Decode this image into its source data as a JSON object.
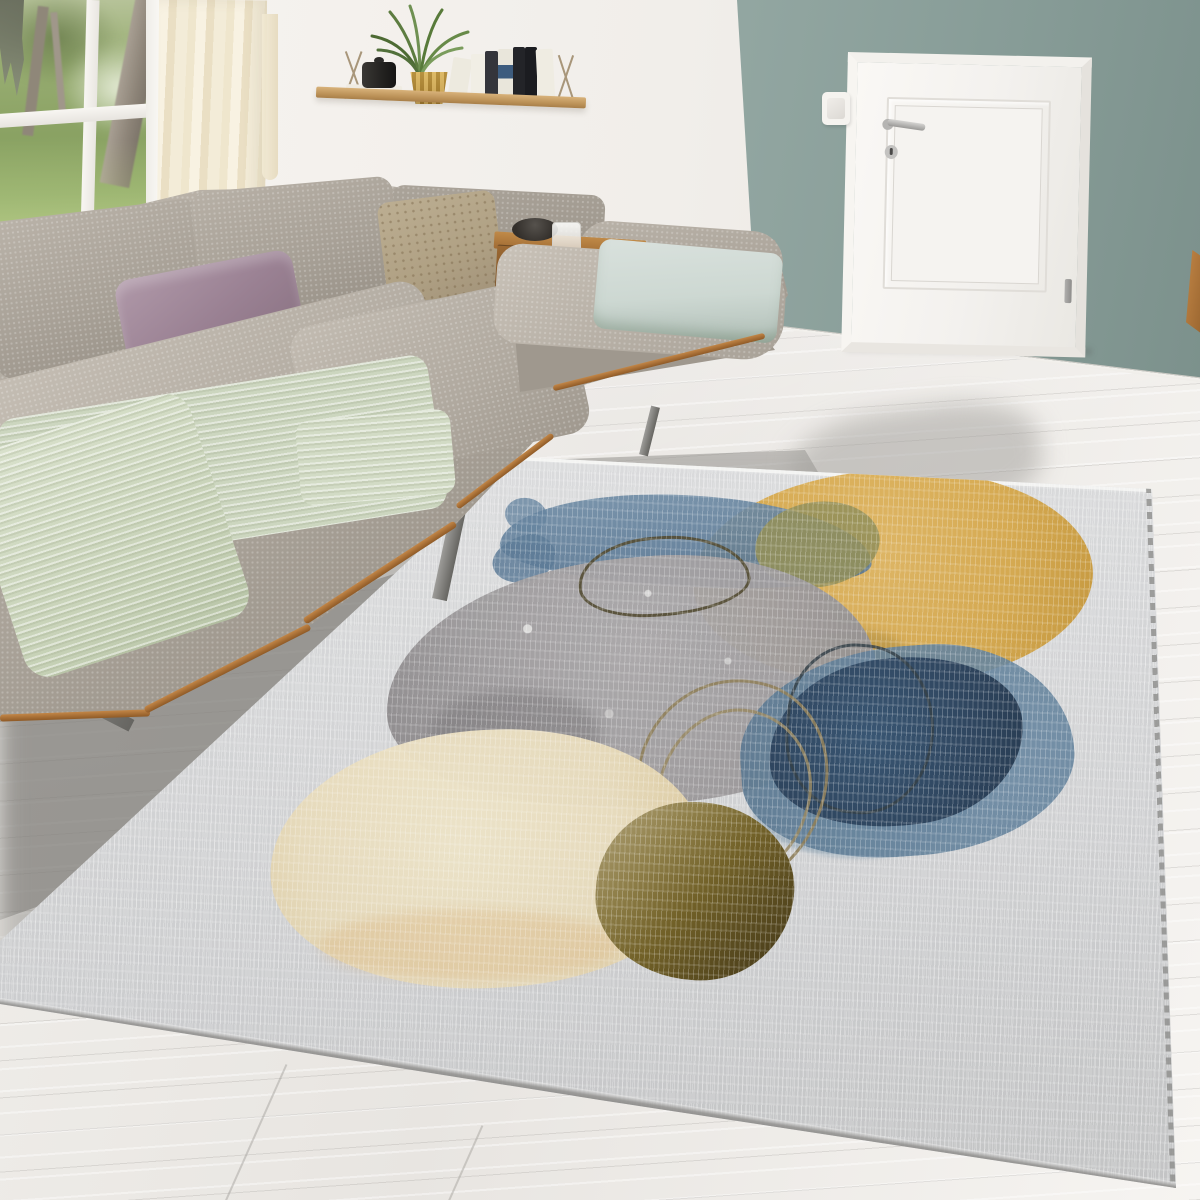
{
  "scene": {
    "type": "natural-image",
    "description": "Bright living room photo: L-shaped grey boucle corner sofa along a garden window, sage-green accent wall with white interior door, wooden wall shelf with books and a potted plant, whitewashed plank floor, and a large light-grey area rug printed with abstract watercolor circles.",
    "objects": [
      {
        "name": "garden-window",
        "note": "white-framed window, green garden with tree trunks and lawn"
      },
      {
        "name": "sheer-curtain",
        "note": "cream curtain panel beside window"
      },
      {
        "name": "wall-shelf",
        "note": "wood plank shelf on wire brackets with white book stack, black jar, brass potted plant, row of book spines"
      },
      {
        "name": "accent-wall",
        "note": "sage grey-green painted wall"
      },
      {
        "name": "interior-door",
        "note": "white panel door with lever handle, keyhole and hinge"
      },
      {
        "name": "light-switch",
        "note": "white rocker switch left of the door"
      },
      {
        "name": "corner-sofa",
        "note": "taupe-grey L-shaped sofa on wood trim base with metal legs"
      },
      {
        "name": "throw-pillows",
        "note": "dusty mauve pillow, beige dotted pillow, pale mint pillow"
      },
      {
        "name": "knit-throw",
        "note": "pale sage knitted blanket on seat"
      },
      {
        "name": "side-table",
        "note": "wood ledge table with dark bowl and drinking glass"
      },
      {
        "name": "area-rug",
        "note": "light grey rug with abstract watercolor print"
      },
      {
        "name": "wood-floor",
        "note": "whitewashed wide planks"
      }
    ]
  },
  "rug_art": {
    "style": "abstract watercolor circles with hand-drawn outline loops",
    "shapes": [
      {
        "name": "blue-brush-stroke",
        "color": "#5a7996"
      },
      {
        "name": "yellow-circle",
        "color": "#d4a443"
      },
      {
        "name": "olive-overlap-patch",
        "color": "#8e8b52"
      },
      {
        "name": "grey-pebble-blob",
        "color": "#9b989a"
      },
      {
        "name": "navy-blob-outer",
        "color": "#5e7e99"
      },
      {
        "name": "navy-blob-core",
        "color": "#263e59"
      },
      {
        "name": "cream-circle",
        "color": "#ecdfbe"
      },
      {
        "name": "olive-brown-circle",
        "color": "#6f5d20"
      },
      {
        "name": "outline-loop-dark",
        "color": "#4b4429"
      },
      {
        "name": "outline-loop-navy",
        "color": "#2d3a42"
      },
      {
        "name": "outline-loop-brown",
        "color": "#8d7c55"
      }
    ]
  },
  "palette": {
    "wall_green_light": "#93a7a2",
    "wall_green": "#879c97",
    "wall_green_dark": "#7c918c",
    "bracket": "#a8967a",
    "book_blue": "#3d5c7e",
    "rug_fringe": "#8d8d8b",
    "art_outline_dark": "#4b4429",
    "art_outline_navy": "#2d3a42",
    "art_outline_brown": "#8d7c55",
    "art_khaki": "#b2a377"
  }
}
